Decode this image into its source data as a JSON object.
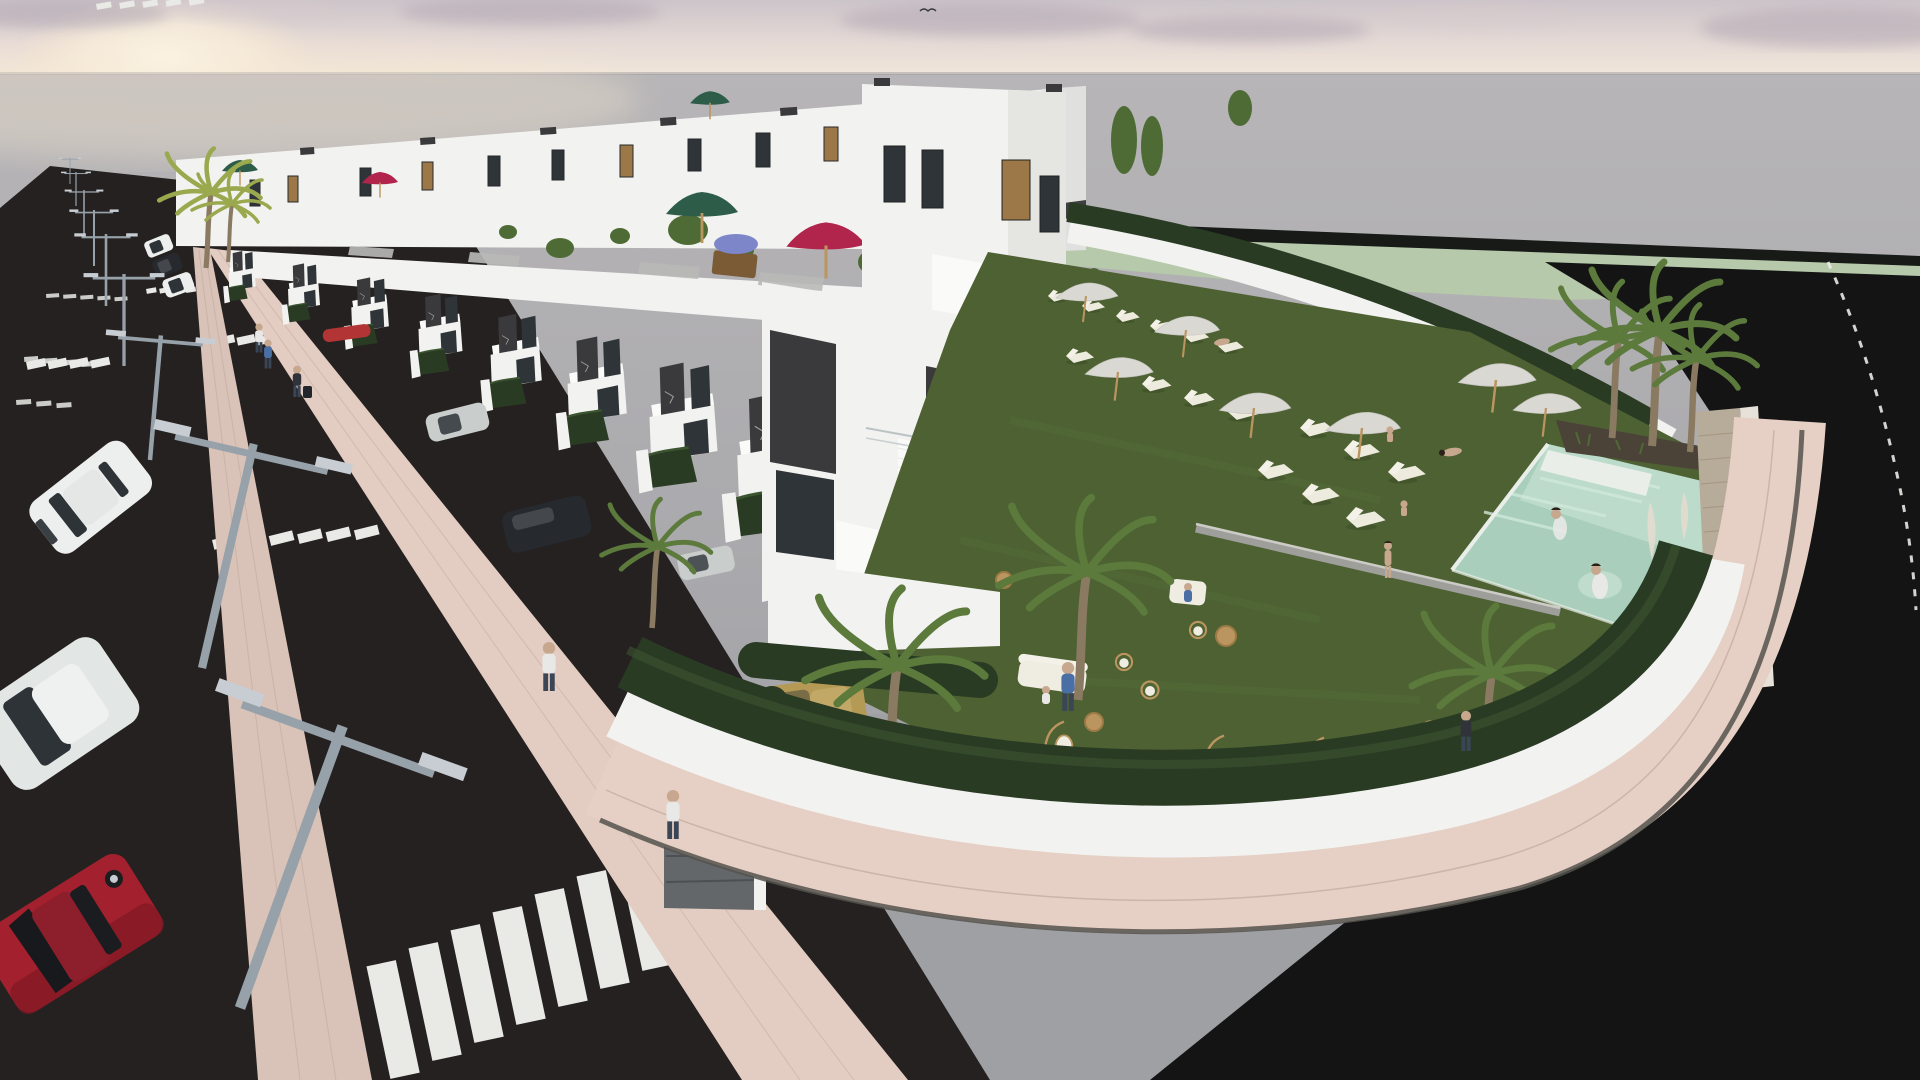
{
  "meta": {
    "type": "3d-architectural-render",
    "description": "Aerial dusk rendering of a row of white townhouses with roof terraces, a street with crosswalks and parked cars on the left, and a communal garden with lawn, seating, sun loungers and a turquoise pool on the right"
  },
  "palette": {
    "sky_top": "#cbc4c9",
    "sky_mid": "#e6dad6",
    "sky_horizon": "#f2e8da",
    "sun_core": "#fdf7e9",
    "sun_halo": "#f6e8d2",
    "cloud_mauve": "#b2a7b2",
    "cloud_soft": "#d8cacd",
    "haze_top": "#b7b5b7",
    "haze_bottom": "#a5a5a9",
    "horizon_line": "#9b9aa0",
    "field_strip_dark": "#181a17",
    "field_green": "#b6c9aa",
    "grass_pale": "#c5d3b9",
    "road_street": "#252120",
    "road_dark": "#131413",
    "median_pink": "#d9c2b7",
    "sidewalk_pink": "#e3ccc1",
    "walk_pink": "#e6cfc4",
    "paver_line": "#c2a89d",
    "curb_dark": "#54524e",
    "marking_white": "#e9e9e6",
    "curb_gray": "#9e9e9a",
    "curb_light": "#cccbc6",
    "house_white": "#f2f2f0",
    "house_bright": "#fafaf8",
    "house_shade": "#e0e0de",
    "roof_wedge": "#3d3f41",
    "panel_charcoal": "#3a3a3c",
    "glass_dark": "#2f3438",
    "glass_mid": "#5c666c",
    "mullion": "#aeb6ba",
    "decor_crack": "#b9bcb8",
    "wood": "#9c7748",
    "wood_dark": "#7a5b36",
    "terrace_floor": "#b9b9b7",
    "terracotta": "#ae5a3d",
    "plant_green": "#4e6b35",
    "hedge_dark": "#2a3b24",
    "hedge_mid": "#3c5531",
    "lawn": "#4d6132",
    "lawn_streak": "#5a6f3c",
    "pool_water": "#a9cfbc",
    "pool_light": "#cfe8d9",
    "pool_step": "#e9efe8",
    "pool_glow": "#eaf4ec",
    "soil": "#4b4238",
    "palm_trunk": "#8b7a62",
    "palm_green": "#5c7a3c",
    "palm_yellow": "#9aa84e",
    "pampas": "#e3ddd0",
    "stone": "#b7ab99",
    "stone_line": "#a3977f",
    "slat_light": "#e6e2d9",
    "slat_line": "#b9b4a6",
    "umb_green": "#2d5c49",
    "umb_red": "#b1244b",
    "umb_tan": "#c9b386",
    "umb_blue": "#6f8fc0",
    "umb_white": "#f2f3f2",
    "parasol": "#d9d8d3",
    "lounger": "#edeade",
    "lounger_back": "#f4f2e8",
    "rattan": "#bb955f",
    "rattan_dark": "#9c7a45",
    "furn_white": "#efece2",
    "car_white": "#edefee",
    "car_roof": "#e4e7e6",
    "car_silver": "#c9cdcc",
    "car_silver2": "#e2e6e5",
    "car_red": "#a3202e",
    "car_red_dark": "#7e1824",
    "car_red_roof": "#8d1f2c",
    "car_dark": "#26292d",
    "car_dark_hl": "#44484c",
    "car_tan": "#b59a55",
    "car_tan_roof": "#c2a866",
    "car_redroof": "#b23434",
    "car_glass": "#2e3338",
    "lamp_gray": "#97a1aa",
    "lamp_light": "#c7cdd2",
    "fence_gray": "#63676a",
    "fence_line": "#4c5054",
    "skin": "#c7a88e",
    "hair_dark": "#2a2118",
    "shirt_blue": "#4a6fa5",
    "shirt_white": "#e8e8e6",
    "shirt_dark": "#30343a",
    "pants": "#3a4556",
    "bird": "#3a3a3c"
  },
  "scene": {
    "objects": [
      "sunset-sky",
      "sun-glow",
      "clouds",
      "distance-haze",
      "green-field",
      "perimeter-road",
      "main-street",
      "pink-median",
      "pink-sidewalk",
      "zebra-crosswalks",
      "parking-bay-markings",
      "street-lamps",
      "townhouse-back-row",
      "townhouse-front-row",
      "end-building",
      "roof-terraces",
      "roof-umbrellas",
      "communal-garden",
      "garden-hedge",
      "garden-wall",
      "curved-pavement",
      "swimming-pool",
      "pool-palms",
      "pampas-grass",
      "stone-feature-wall",
      "sun-loungers",
      "parasols",
      "garden-furniture",
      "palm-trees",
      "cars",
      "pedestrians",
      "swimmers",
      "bird"
    ],
    "counts": {
      "townhouse_units_visible": 20,
      "sun_loungers": 17,
      "parasols": 7,
      "roof_umbrellas": 7,
      "street_lamps": 9,
      "cars_on_street": 6,
      "cars_in_driveways": 5,
      "pedestrians": 7,
      "swimmers": 2,
      "zebra_crosswalks": 5
    },
    "roof_umbrella_colors": [
      "green",
      "red",
      "green",
      "tan",
      "green",
      "magenta",
      "blue-white-striped"
    ]
  }
}
